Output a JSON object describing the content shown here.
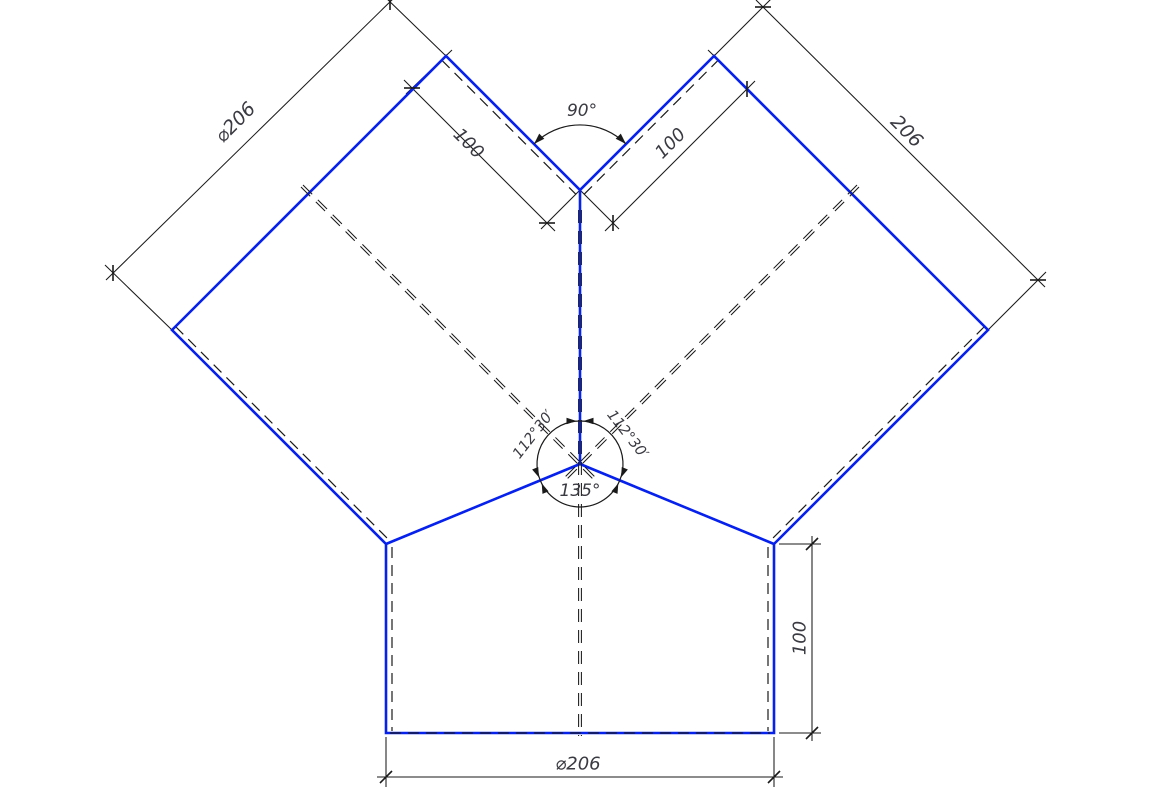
{
  "drawing": {
    "title": "Y-branch pipe fitting dimensioned drawing",
    "colors": {
      "outline_blue": "#0721ec",
      "dimension_black": "#1a1a1a",
      "text_color": "#3a3a42",
      "background": "#ffffff"
    },
    "labels": {
      "left_diameter": "⌀206",
      "right_length": "206",
      "left_branch_length": "100",
      "right_branch_length": "100",
      "top_angle": "90°",
      "left_junction_angle": "112°30′",
      "right_junction_angle": "112°30′",
      "bottom_junction_angle": "135°",
      "outlet_height": "100",
      "bottom_diameter": "⌀206"
    }
  }
}
